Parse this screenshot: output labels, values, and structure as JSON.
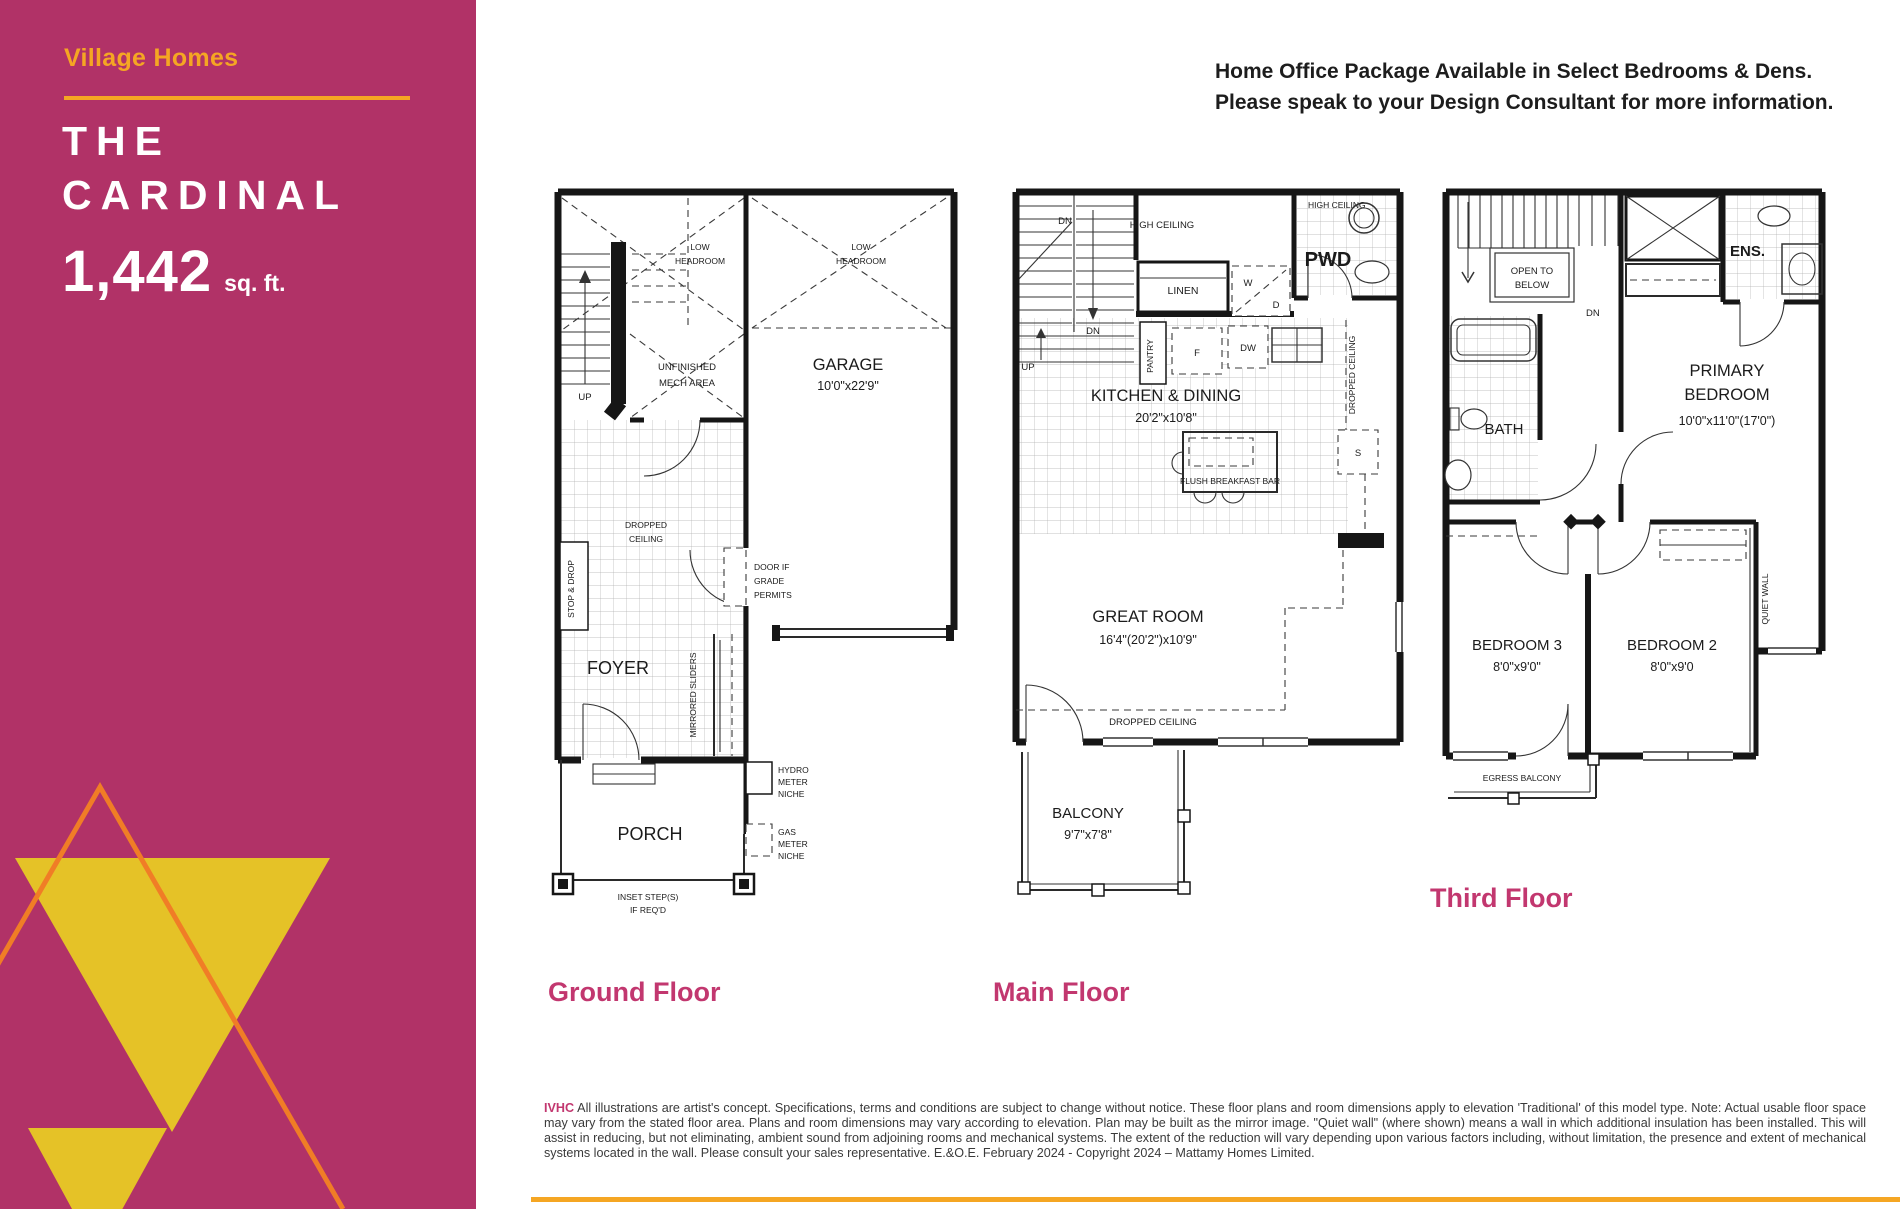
{
  "colors": {
    "sidebar_magenta": "#B13267",
    "brand_gold": "#F5A623",
    "triangle_gold": "#E5C227",
    "triangle_orange": "#F07D26",
    "floor_label_pink": "#C2376F"
  },
  "sidebar": {
    "brand": "Village Homes",
    "title_line1": "THE",
    "title_line2": "CARDINAL",
    "sqft_value": "1,442",
    "sqft_unit": "sq. ft."
  },
  "header": {
    "line1": "Home Office Package Available in Select Bedrooms & Dens.",
    "line2": "Please speak to your Design Consultant for more information."
  },
  "plans": {
    "ground": {
      "label": "Ground Floor",
      "texts": {
        "low1_l1": "LOW",
        "low1_l2": "HEADROOM",
        "low2_l1": "LOW",
        "low2_l2": "HEADROOM",
        "up": "UP",
        "mech_l1": "UNFINISHED",
        "mech_l2": "MECH AREA",
        "garage": "GARAGE",
        "garage_dims": "10'0\"x22'9\"",
        "dropped_l1": "DROPPED",
        "dropped_l2": "CEILING",
        "stop_drop": "STOP & DROP",
        "door_grade_l1": "DOOR IF",
        "door_grade_l2": "GRADE",
        "door_grade_l3": "PERMITS",
        "foyer": "FOYER",
        "mirrored": "MIRRORED SLIDERS",
        "hydro_l1": "HYDRO",
        "hydro_l2": "METER",
        "hydro_l3": "NICHE",
        "gas_l1": "GAS",
        "gas_l2": "METER",
        "gas_l3": "NICHE",
        "porch": "PORCH",
        "inset_l1": "INSET STEP(S)",
        "inset_l2": "IF REQ'D"
      }
    },
    "main": {
      "label": "Main Floor",
      "texts": {
        "dn1": "DN",
        "dn2": "DN",
        "up": "UP",
        "high_ceiling1": "HIGH CEILING",
        "high_ceiling2": "HIGH CEILING",
        "pwd": "PWD",
        "linen": "LINEN",
        "w": "W",
        "d": "D",
        "pantry": "PANTRY",
        "f": "F",
        "dw": "DW",
        "dropped_vert": "DROPPED CEILING",
        "kitchen": "KITCHEN & DINING",
        "kitchen_dims": "20'2\"x10'8\"",
        "breakfast": "FLUSH BREAKFAST BAR",
        "s": "S",
        "great": "GREAT ROOM",
        "great_dims": "16'4\"(20'2\")x10'9\"",
        "dropped2": "DROPPED CEILING",
        "balcony": "BALCONY",
        "balcony_dims": "9'7\"x7'8\""
      }
    },
    "third": {
      "label": "Third Floor",
      "texts": {
        "open_l1": "OPEN TO",
        "open_l2": "BELOW",
        "dn": "DN",
        "ens": "ENS.",
        "bath": "BATH",
        "primary_l1": "PRIMARY",
        "primary_l2": "BEDROOM",
        "primary_dims": "10'0\"x11'0\"(17'0\")",
        "bed3": "BEDROOM 3",
        "bed3_dims": "8'0\"x9'0\"",
        "bed2": "BEDROOM 2",
        "bed2_dims": "8'0\"x9'0",
        "quiet": "QUIET WALL",
        "egress": "EGRESS BALCONY"
      }
    }
  },
  "footer": {
    "code": "IVHC",
    "disclaimer": "All illustrations are artist's concept. Specifications, terms and conditions are subject to change without notice. These floor plans and room dimensions apply to elevation 'Traditional' of this model type. Note: Actual usable floor space may vary from the stated floor area. Plans and room dimensions may vary according to elevation. Plan may be built as the mirror image. \"Quiet wall\" (where shown) means a wall in which additional insulation has been installed. This will assist in reducing, but not eliminating, ambient sound from adjoining rooms and mechanical systems. The extent of the reduction will vary depending upon various factors including, without limitation, the presence and extent of mechanical systems located in the wall. Please consult your sales representative. E.&O.E. February 2024 - Copyright 2024 – Mattamy Homes Limited."
  }
}
